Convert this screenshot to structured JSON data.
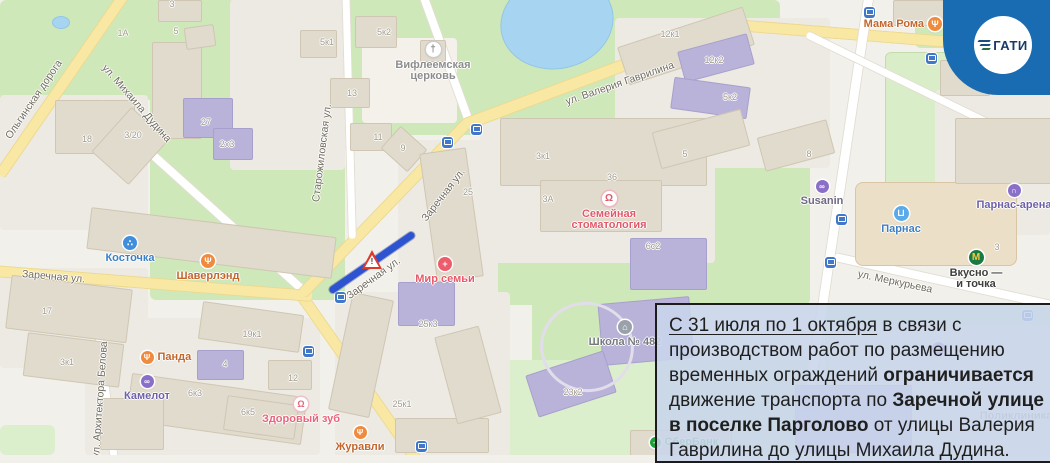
{
  "logo": {
    "text": "ГАТИ",
    "badge_color": "#1a6cb2"
  },
  "overlay": {
    "background": "rgba(200,213,235,0.88)",
    "border_color": "#1c1c1c",
    "segments": [
      {
        "t": "С 31 июля по 1 октября",
        "u": true
      },
      {
        "t": " в связи с",
        "br": true
      },
      {
        "t": "производством работ по размещению",
        "br": true
      },
      {
        "t": "временных ограждений "
      },
      {
        "t": "ограничивается",
        "b": true,
        "br": true
      },
      {
        "t": "движение транспорта по "
      },
      {
        "t": "Заречной улице",
        "b": true,
        "br": true
      },
      {
        "t": "в поселке Парголово",
        "b": true
      },
      {
        "t": " от улицы Валерия",
        "br": true
      },
      {
        "t": "Гаврилина до улицы Михаила Дудина.",
        "br": true
      }
    ]
  },
  "map": {
    "closure": {
      "x1": 330,
      "y1": 291,
      "x2": 414,
      "y2": 233,
      "color": "#2e53d0",
      "sign": "roadworks-triangle"
    },
    "street_labels": [
      {
        "text": "Ольгинская дорога",
        "x": 8,
        "y": 132,
        "rot": -56
      },
      {
        "text": "ул. Михаила Дудина",
        "x": 104,
        "y": 60,
        "rot": 49
      },
      {
        "text": "Старожиловская ул.",
        "x": 316,
        "y": 196,
        "rot": -83
      },
      {
        "text": "Заречная ул.",
        "x": 22,
        "y": 268,
        "rot": 5
      },
      {
        "text": "Заречная ул.",
        "x": 348,
        "y": 291,
        "rot": -36
      },
      {
        "text": "Заречная ул.",
        "x": 424,
        "y": 214,
        "rot": -52
      },
      {
        "text": "ул. Валерия Гаврилина",
        "x": 566,
        "y": 96,
        "rot": -19
      },
      {
        "text": "ул. Меркурьева",
        "x": 858,
        "y": 268,
        "rot": 12
      },
      {
        "text": "ул. Архитектора Белова",
        "x": 96,
        "y": 452,
        "rot": -86
      }
    ],
    "building_labels": [
      {
        "text": "1А",
        "x": 123,
        "y": 33
      },
      {
        "text": "3",
        "x": 172,
        "y": 4
      },
      {
        "text": "5",
        "x": 176,
        "y": 31
      },
      {
        "text": "5к1",
        "x": 327,
        "y": 42
      },
      {
        "text": "5к2",
        "x": 384,
        "y": 32
      },
      {
        "text": "13",
        "x": 352,
        "y": 93
      },
      {
        "text": "11",
        "x": 378,
        "y": 137
      },
      {
        "text": "9",
        "x": 403,
        "y": 148
      },
      {
        "text": "18",
        "x": 87,
        "y": 139
      },
      {
        "text": "3/20",
        "x": 133,
        "y": 135
      },
      {
        "text": "27",
        "x": 206,
        "y": 122
      },
      {
        "text": "2х3",
        "x": 227,
        "y": 144
      },
      {
        "text": "17",
        "x": 47,
        "y": 311
      },
      {
        "text": "3к1",
        "x": 67,
        "y": 362
      },
      {
        "text": "19к1",
        "x": 252,
        "y": 334
      },
      {
        "text": "4",
        "x": 225,
        "y": 364
      },
      {
        "text": "6к3",
        "x": 195,
        "y": 393
      },
      {
        "text": "6к5",
        "x": 248,
        "y": 412
      },
      {
        "text": "12",
        "x": 293,
        "y": 378
      },
      {
        "text": "25",
        "x": 468,
        "y": 192
      },
      {
        "text": "25к3",
        "x": 428,
        "y": 324
      },
      {
        "text": "25к1",
        "x": 402,
        "y": 404
      },
      {
        "text": "23к2",
        "x": 573,
        "y": 392
      },
      {
        "text": "3к1",
        "x": 543,
        "y": 156
      },
      {
        "text": "3А",
        "x": 548,
        "y": 199
      },
      {
        "text": "36",
        "x": 612,
        "y": 177
      },
      {
        "text": "6с2",
        "x": 653,
        "y": 246
      },
      {
        "text": "5",
        "x": 685,
        "y": 154
      },
      {
        "text": "12к1",
        "x": 670,
        "y": 34
      },
      {
        "text": "12к2",
        "x": 714,
        "y": 60
      },
      {
        "text": "5к2",
        "x": 730,
        "y": 97
      },
      {
        "text": "8",
        "x": 809,
        "y": 154
      },
      {
        "text": "3",
        "x": 997,
        "y": 247
      }
    ],
    "pois": [
      {
        "id": "bethlehem-church",
        "x": 433,
        "y": 49,
        "d": 15,
        "bg": "#ffffff",
        "bd": "#cccccc",
        "glyph": "†",
        "gc": "#8a8a8a",
        "label": [
          "Вифлеемская",
          "церковь"
        ],
        "lc": "#8d8d8d",
        "pos": "below"
      },
      {
        "id": "kostochka",
        "x": 130,
        "y": 243,
        "d": 14,
        "bg": "#3f8fdd",
        "glyph": "∴",
        "gc": "#ffffff",
        "label": [
          "Косточка"
        ],
        "lc": "#3b7fc4",
        "pos": "below"
      },
      {
        "id": "shaverlend",
        "x": 208,
        "y": 261,
        "d": 14,
        "bg": "#ef8b3f",
        "glyph": "Ψ",
        "gc": "#ffffff",
        "label": [
          "Шаверлэнд"
        ],
        "lc": "#c2662e",
        "pos": "below"
      },
      {
        "id": "panda",
        "x": 147,
        "y": 357,
        "d": 13,
        "bg": "#ef8b3f",
        "glyph": "Ψ",
        "gc": "#ffffff",
        "label": [
          "Панда"
        ],
        "lc": "#c2662e",
        "pos": "right"
      },
      {
        "id": "kamelot",
        "x": 147,
        "y": 381,
        "d": 13,
        "bg": "#8a6fc8",
        "glyph": "∞",
        "gc": "#ffffff",
        "label": [
          "Камелот"
        ],
        "lc": "#6e61a8",
        "pos": "below"
      },
      {
        "id": "zdorovy-zub",
        "x": 301,
        "y": 404,
        "d": 14,
        "bg": "#ffffff",
        "bd": "#f0c0c8",
        "glyph": "Ω",
        "gc": "#e8657a",
        "label": [
          "Здоровый зуб"
        ],
        "lc": "#e8657a",
        "pos": "below"
      },
      {
        "id": "zhuravli",
        "x": 360,
        "y": 432,
        "d": 13,
        "bg": "#ef8b3f",
        "glyph": "Ψ",
        "gc": "#ffffff",
        "label": [
          "Журавли"
        ],
        "lc": "#c2662e",
        "pos": "below"
      },
      {
        "id": "mir-semyi",
        "x": 445,
        "y": 264,
        "d": 14,
        "bg": "#ee5c6c",
        "glyph": "+",
        "gc": "#ffffff",
        "label": [
          "Мир семьи"
        ],
        "lc": "#e8596a",
        "pos": "below"
      },
      {
        "id": "semeynaya-stomatologiya",
        "x": 609,
        "y": 198,
        "d": 15,
        "bg": "#ffffff",
        "bd": "#eeb8c0",
        "glyph": "Ω",
        "gc": "#e05a6a",
        "label": [
          "Семейная",
          "стоматология"
        ],
        "lc": "#e05a6a",
        "pos": "below"
      },
      {
        "id": "shkola-482",
        "x": 625,
        "y": 327,
        "d": 14,
        "bg": "#9ba1ab",
        "glyph": "⌂",
        "gc": "#ffffff",
        "label": [
          "Школа № 482"
        ],
        "lc": "#75797e",
        "pos": "below"
      },
      {
        "id": "susanin",
        "x": 822,
        "y": 186,
        "d": 13,
        "bg": "#8a6fc8",
        "glyph": "∞",
        "gc": "#ffffff",
        "label": [
          "Susanin"
        ],
        "lc": "#6e6880",
        "pos": "below"
      },
      {
        "id": "parnas",
        "x": 901,
        "y": 213,
        "d": 15,
        "bg": "#5aa9e8",
        "glyph": "⊔",
        "gc": "#ffffff",
        "label": [
          "Парнас"
        ],
        "lc": "#3f7fc1",
        "pos": "below"
      },
      {
        "id": "parnas-arena",
        "x": 1014,
        "y": 190,
        "d": 13,
        "bg": "#8a6fc8",
        "glyph": "∩",
        "gc": "#ffffff",
        "label": [
          "Парнас-арена"
        ],
        "lc": "#6e61a8",
        "pos": "below"
      },
      {
        "id": "vkusno-i-tochka",
        "x": 976,
        "y": 257,
        "d": 15,
        "bg": "#1b7a40",
        "glyph": "М",
        "gc": "#f7c843",
        "label": [
          "Вкусно —",
          "и точка"
        ],
        "lc": "#3f3f3f",
        "pos": "below"
      },
      {
        "id": "mama-roma",
        "x": 935,
        "y": 24,
        "d": 14,
        "bg": "#ef8b3f",
        "glyph": "Ψ",
        "gc": "#ffffff",
        "label": [
          "Мама Рома"
        ],
        "lc": "#c2662e",
        "pos": "left"
      },
      {
        "id": "sberbank",
        "x": 655,
        "y": 442,
        "d": 11,
        "bg": "#21a038",
        "glyph": "✓",
        "gc": "#ffffff",
        "label": [
          "СберБанк"
        ],
        "lc": "#21a038",
        "pos": "right"
      },
      {
        "id": "poliklinika-117",
        "x": 1016,
        "y": 408,
        "d": 0,
        "label": [
          "Поликлиника",
          "№ 117"
        ],
        "lc": "#9a948a",
        "pos": "below"
      },
      {
        "id": "poi-purple",
        "x": 938,
        "y": 348,
        "d": 13,
        "bg": "#8a6fc8",
        "glyph": "∞",
        "gc": "#ffffff",
        "label": [],
        "lc": "#6e61a8",
        "pos": "below"
      }
    ],
    "bus_stops": [
      [
        447,
        142
      ],
      [
        476,
        129
      ],
      [
        340,
        297
      ],
      [
        308,
        351
      ],
      [
        421,
        446
      ],
      [
        869,
        12
      ],
      [
        841,
        219
      ],
      [
        830,
        262
      ],
      [
        931,
        58
      ],
      [
        1027,
        315
      ]
    ]
  }
}
